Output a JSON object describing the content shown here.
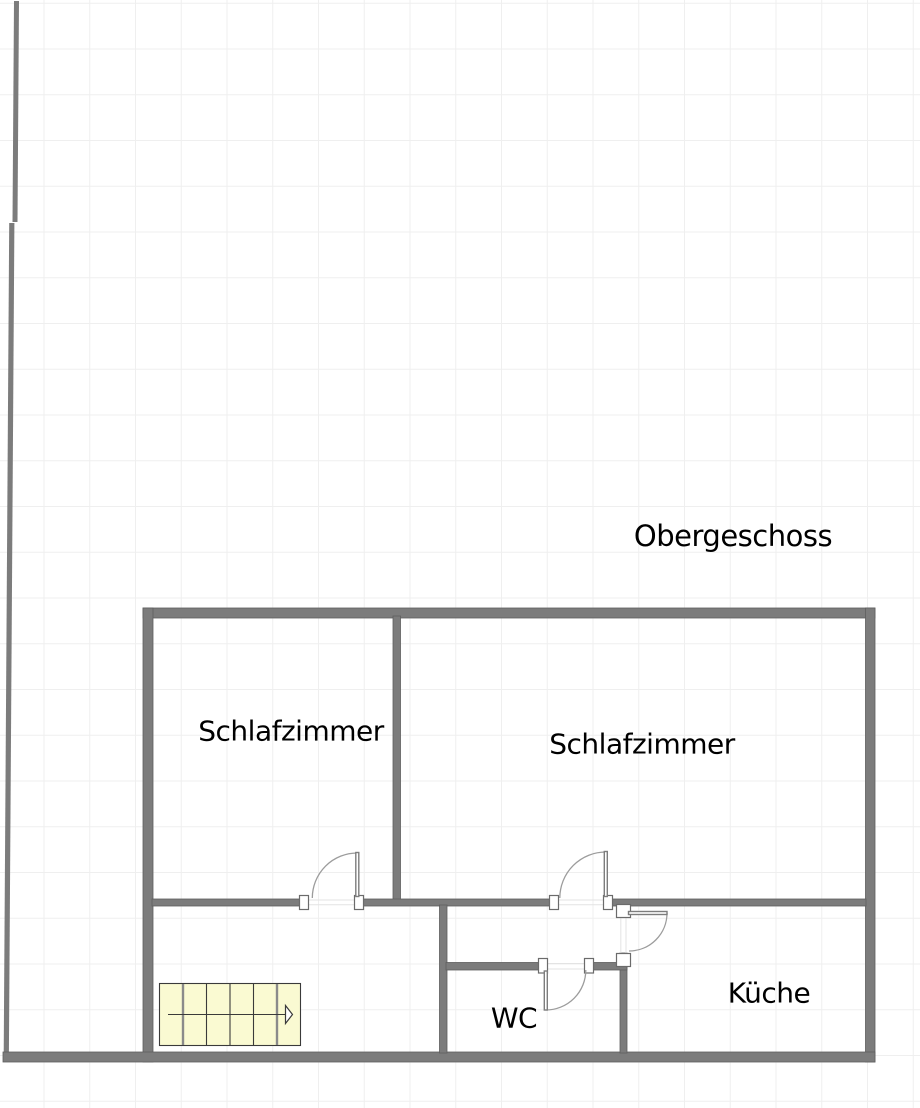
{
  "floor_plan": {
    "title": "Obergeschoss",
    "rooms": [
      {
        "id": "bedroom-left",
        "label": "Schlafzimmer"
      },
      {
        "id": "bedroom-right",
        "label": "Schlafzimmer"
      },
      {
        "id": "wc",
        "label": "WC"
      },
      {
        "id": "kitchen",
        "label": "Küche"
      }
    ],
    "staircase": {
      "steps": 6,
      "direction": "right"
    },
    "doors": 4,
    "colors": {
      "wall": "#7c7c7c",
      "wall_edge": "#5e5e5e",
      "stairs_fill": "#fafad2",
      "stairs_line": "#3a3a3a",
      "door_arc": "#9c9c9c",
      "grid": "#efefef",
      "label_text": "#000000",
      "background": "#ffffff"
    }
  }
}
